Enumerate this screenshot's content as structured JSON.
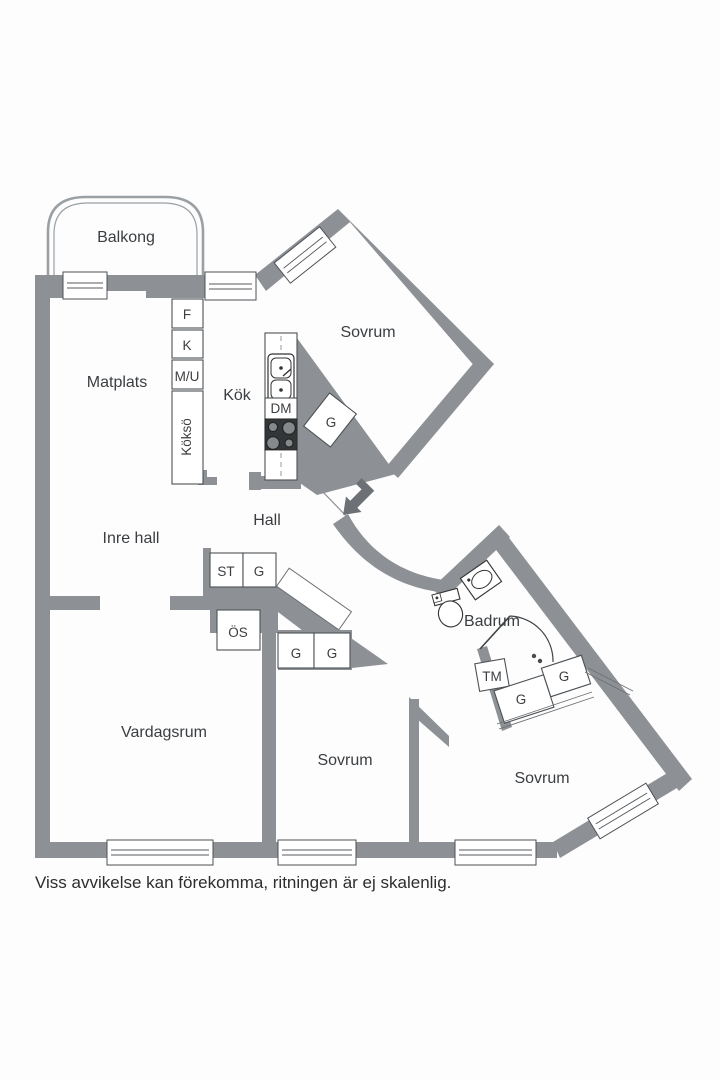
{
  "colors": {
    "wall": "#8d9195",
    "arrow": "#6d7175",
    "stove_body": "#333639",
    "text": "#3b3e41",
    "background": "#fdfdfd"
  },
  "floor_plan": {
    "balcony": {
      "label": "Balkong"
    },
    "dining": {
      "label": "Matplats"
    },
    "kitchen": {
      "label": "Kök",
      "fridge": "F",
      "freezer": "K",
      "micro_oven": "M/U",
      "island": "Köksö",
      "dishwasher": "DM"
    },
    "bedroom_top": {
      "label": "Sovrum",
      "wardrobe": "G"
    },
    "hall": {
      "label": "Hall"
    },
    "inner_hall": {
      "label": "Inre hall",
      "closet_st": "ST",
      "closet_g": "G",
      "closet_os": "ÖS"
    },
    "living_room": {
      "label": "Vardagsrum"
    },
    "bedroom_mid": {
      "label": "Sovrum",
      "wardrobe_1": "G",
      "wardrobe_2": "G"
    },
    "bathroom": {
      "label": "Badrum",
      "washing_machine": "TM"
    },
    "bedroom_right": {
      "label": "Sovrum",
      "wardrobe_1": "G",
      "wardrobe_2": "G"
    },
    "caption": "Viss avvikelse kan förekomma, ritningen är ej skalenlig."
  }
}
